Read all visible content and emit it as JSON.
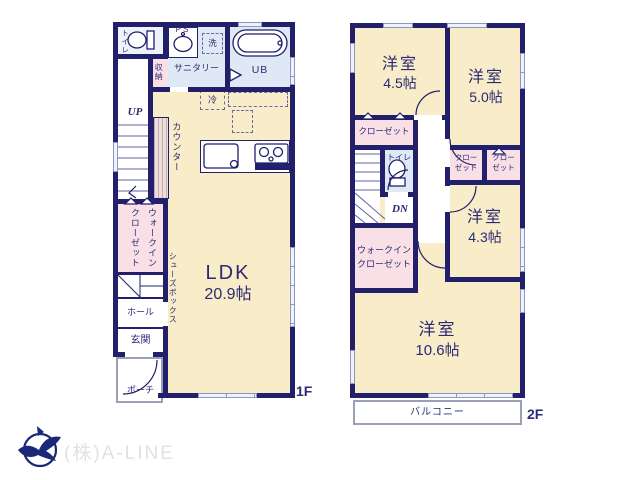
{
  "colors": {
    "wall": "#221f6b",
    "room_cream": "#f8ecc9",
    "room_blue": "#dfe9f5",
    "closet_pink": "#f9e0e6",
    "label_navy": "#2b2a74",
    "outline_gray": "#9aa0b5",
    "logo_navy": "#1b2878",
    "watermark_gray": "#e2e2e2"
  },
  "floor1": {
    "floor_label": "1F",
    "rooms": {
      "toilet": "トイレ",
      "ps": "PS",
      "wash": "洗",
      "sanitary": "サニタリー",
      "storage": "収納",
      "ub": "UB",
      "up": "UP",
      "counter": "カウンター",
      "fridge": "冷",
      "ldk_name": "LDK",
      "ldk_size": "20.9帖",
      "wic": "ウォークインクローゼット",
      "shoes": "シューズボックス",
      "hall": "ホール",
      "entrance": "玄関",
      "porch": "ポーチ"
    }
  },
  "floor2": {
    "floor_label": "2F",
    "rooms": {
      "room45_name": "洋室",
      "room45_size": "4.5帖",
      "room50_name": "洋室",
      "room50_size": "5.0帖",
      "closet": "クローゼット",
      "toilet": "トイレ",
      "dn": "DN",
      "closet_small": {
        "line1": "クロー",
        "line2": "ゼット"
      },
      "room43_name": "洋室",
      "room43_size": "4.3帖",
      "wic_line1": "ウォークイン",
      "wic_line2": "クローゼット",
      "room106_name": "洋室",
      "room106_size": "10.6帖",
      "balcony": "バルコニー"
    }
  },
  "footer": {
    "company": "(株)A-LINE"
  }
}
